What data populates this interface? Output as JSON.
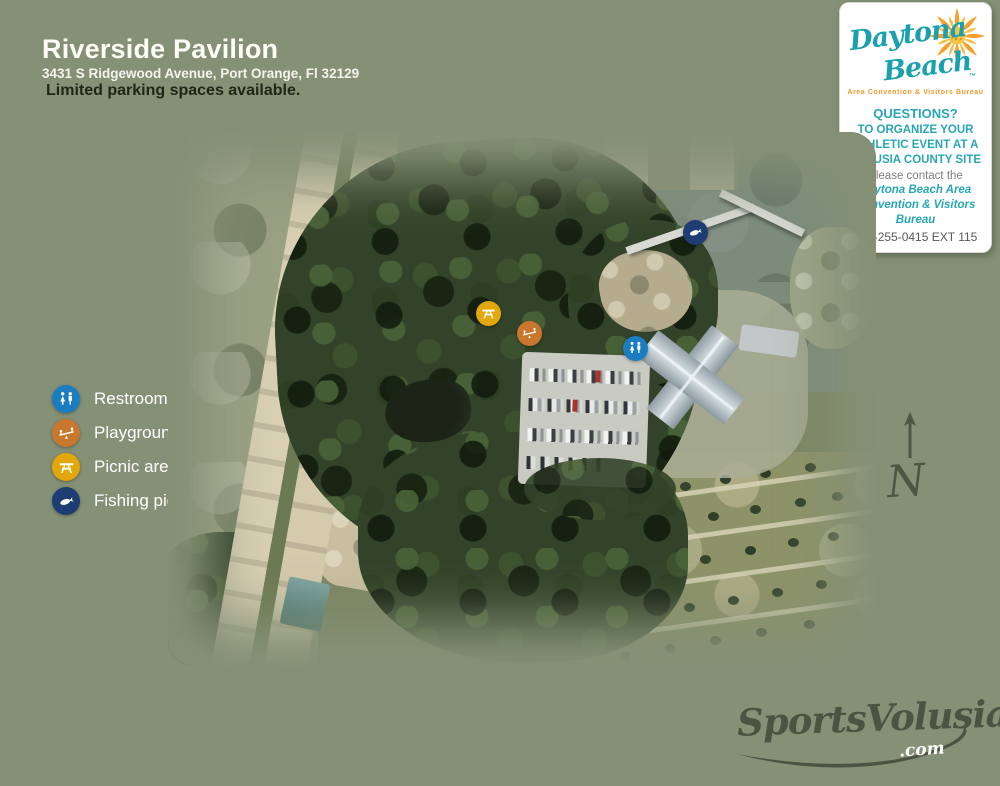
{
  "palette": {
    "page_background": "#859176",
    "title_text": "#fdfdf6",
    "note_text": "#1f2517",
    "teal_brand": "#1ba0ad",
    "orange_brand": "#ef9a2b",
    "restrooms_pin": "#1a7dc0",
    "playground_pin": "#c8772d",
    "picnic_pin": "#e2a70a",
    "fishing_pin": "#1e3d72",
    "watermark": "#4b5342"
  },
  "header": {
    "title": "Riverside Pavilion",
    "address": "3431 S Ridgewood Avenue, Port Orange, Fl 32129",
    "note": "Limited parking spaces available."
  },
  "info_card": {
    "logo_word1": "Daytona",
    "logo_word2": "Beach",
    "logo_tm": "™",
    "logo_subtitle": "Area Convention & Visitors Bureau",
    "questions": "QUESTIONS?",
    "body": "TO ORGANIZE YOUR ATHLETIC EVENT AT A VOLUSIA COUNTY SITE",
    "contact_intro": "Please contact the",
    "contact_name": "Daytona Beach Area Convention & Visitors Bureau",
    "phone": "386-255-0415 EXT 115"
  },
  "legend": {
    "items": [
      {
        "label": "Restrooms",
        "icon": "restrooms-icon",
        "color": "#1a7dc0"
      },
      {
        "label": "Playground",
        "icon": "playground-icon",
        "color": "#c8772d"
      },
      {
        "label": "Picnic area",
        "icon": "picnic-table-icon",
        "color": "#e2a70a"
      },
      {
        "label": "Fishing pier",
        "icon": "fish-icon",
        "color": "#1e3d72"
      }
    ]
  },
  "map": {
    "markers": [
      {
        "name": "fishing-pier-marker",
        "legend_ref": "Fishing pier"
      },
      {
        "name": "picnic-area-marker",
        "legend_ref": "Picnic area"
      },
      {
        "name": "playground-marker",
        "legend_ref": "Playground"
      },
      {
        "name": "restrooms-marker",
        "legend_ref": "Restrooms"
      }
    ]
  },
  "compass": {
    "label": "N"
  },
  "watermark": {
    "brand": "SportsVolusia",
    "suffix": ".com"
  }
}
